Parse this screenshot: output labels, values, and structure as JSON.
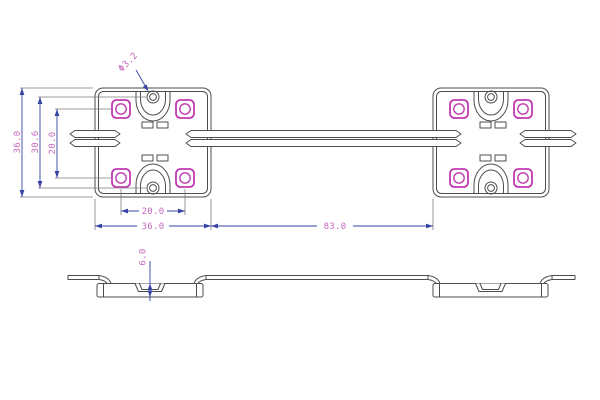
{
  "page": {
    "background": "#ffffff",
    "description": "LED module technical drawing, top view of two 4-LED modules joined by wires plus side profile view"
  },
  "colors": {
    "outline": "#4d4d4d",
    "dimension_line": "#3744a6",
    "dimension_text": "#c468bd",
    "extension_line": "#7d7d7d",
    "led_accent": "#c23ab0"
  },
  "top_view": {
    "dimensions": {
      "module_height": "36.0",
      "hole_pitch": "30.6",
      "led_pitch_vertical": "20.0",
      "led_pitch_horizontal": "20.0",
      "module_width": "36.0",
      "wire_span": "83.0",
      "hole_diameter": "Φ3.2"
    }
  },
  "side_view": {
    "dimensions": {
      "module_thickness": "6.0"
    }
  }
}
